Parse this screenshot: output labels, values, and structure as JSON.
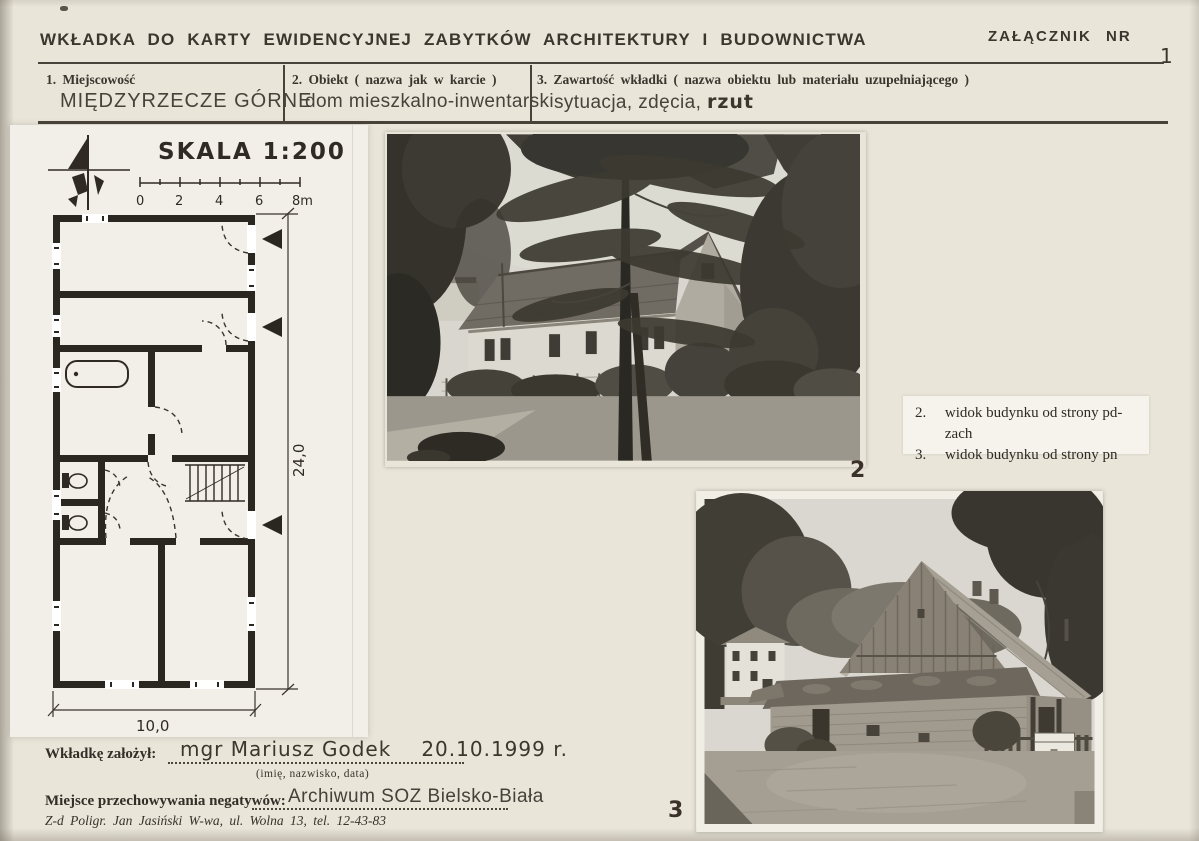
{
  "page": {
    "title": "WKŁADKA DO KARTY EWIDENCYJNEJ ZABYTKÓW ARCHITEKTURY I BUDOWNICTWA",
    "attachment_label": "ZAŁĄCZNIK NR",
    "attachment_number": "1"
  },
  "fields": [
    {
      "label": "1. Miejscowość",
      "value": "MIĘDZYRZECZE GÓRNE"
    },
    {
      "label": "2. Obiekt ( nazwa jak w karcie )",
      "value": "dom mieszkalno-inwentarski"
    },
    {
      "label": "3. Zawartość wkładki ( nazwa obiektu lub materiału uzupełniającego )",
      "value_typed": "sytuacja, zdęcia,",
      "value_hand": "rzut"
    }
  ],
  "plan": {
    "scale_label": "SKALA 1:200",
    "scale_ticks": [
      "0",
      "2",
      "4",
      "6",
      "8m"
    ],
    "dim_vertical": "24,0",
    "dim_horizontal": "10,0"
  },
  "photos": {
    "photo2_number": "2",
    "photo3_number": "3"
  },
  "captions": [
    {
      "num": "2.",
      "text": "widok budynku od strony pd-zach"
    },
    {
      "num": "3.",
      "text": "widok budynku od strony pn"
    }
  ],
  "footer": {
    "founder_label": "Wkładkę założył:",
    "founder_name": "mgr Mariusz Godek",
    "founder_date": "20.10.1999 r.",
    "founder_hint": "(imię, nazwisko, data)",
    "negatives_label": "Miejsce przechowywania negatywów:",
    "negatives_value": "Archiwum SOZ Bielsko-Biała",
    "printer_note": "Z-d Poligr. Jan Jasiński W-wa, ul. Wolna 13, tel. 12-43-83"
  },
  "colors": {
    "ink": "#35302a",
    "paper": "#e9e5d9",
    "plan_paper": "#f2efe8"
  }
}
